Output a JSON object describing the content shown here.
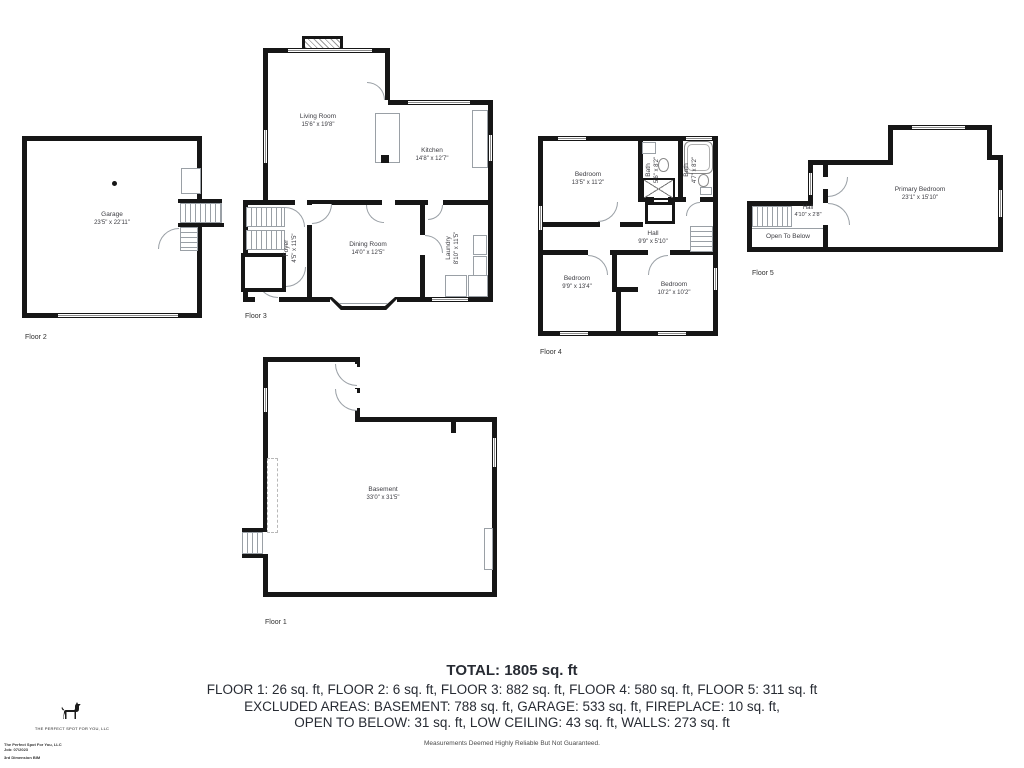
{
  "floors": [
    {
      "label": "Floor 2",
      "rooms": [
        {
          "name": "Garage",
          "dims": "23'5\" x 22'11\""
        }
      ]
    },
    {
      "label": "Floor 3",
      "rooms": [
        {
          "name": "Living Room",
          "dims": "15'6\" x 19'8\""
        },
        {
          "name": "Kitchen",
          "dims": "14'8\" x 12'7\""
        },
        {
          "name": "Dining Room",
          "dims": "14'0\" x 12'5\""
        },
        {
          "name": "Foyer",
          "dims": "4'5\" x 11'5\""
        },
        {
          "name": "Laundry",
          "dims": "8'10\" x 11'5\""
        }
      ]
    },
    {
      "label": "Floor 4",
      "rooms": [
        {
          "name": "Bedroom",
          "dims": "13'5\" x 11'2\""
        },
        {
          "name": "Bath",
          "dims": "5'6\" x 8'2\""
        },
        {
          "name": "Bath",
          "dims": "4'7\" x 8'2\""
        },
        {
          "name": "Hall",
          "dims": "9'9\" x 5'10\""
        },
        {
          "name": "Bedroom",
          "dims": "9'9\" x 13'4\""
        },
        {
          "name": "Bedroom",
          "dims": "10'2\" x 10'2\""
        }
      ]
    },
    {
      "label": "Floor 5",
      "rooms": [
        {
          "name": "Primary Bedroom",
          "dims": "23'1\" x 15'10\""
        },
        {
          "name": "Hall",
          "dims": "4'10\" x 2'8\""
        },
        {
          "name": "Open To Below",
          "dims": ""
        }
      ]
    },
    {
      "label": "Floor 1",
      "rooms": [
        {
          "name": "Basement",
          "dims": "33'0\" x 31'5\""
        }
      ]
    }
  ],
  "summary": {
    "total": "TOTAL: 1805 sq. ft",
    "line1": "FLOOR 1: 26 sq. ft, FLOOR 2: 6 sq. ft, FLOOR 3: 882 sq. ft, FLOOR 4: 580 sq. ft, FLOOR 5: 311 sq. ft",
    "line2": "EXCLUDED AREAS: BASEMENT: 788 sq. ft, GARAGE: 533 sq. ft, FIREPLACE: 10 sq. ft,",
    "line3": "OPEN TO BELOW: 31 sq. ft, LOW CEILING: 43 sq. ft, WALLS: 273 sq. ft",
    "disclaimer": "Measurements Deemed Highly Reliable But Not Guaranteed."
  },
  "branding": {
    "company": "THE PERFECT SPOT FOR YOU, LLC",
    "footer_lines": [
      "The Perfect Spot For You, LLC",
      "Job: 07/2023",
      "3rd Dimension BIM"
    ]
  },
  "colors": {
    "wall": "#161616",
    "room_label": "#3c3c42",
    "summary_text": "#272b33"
  }
}
